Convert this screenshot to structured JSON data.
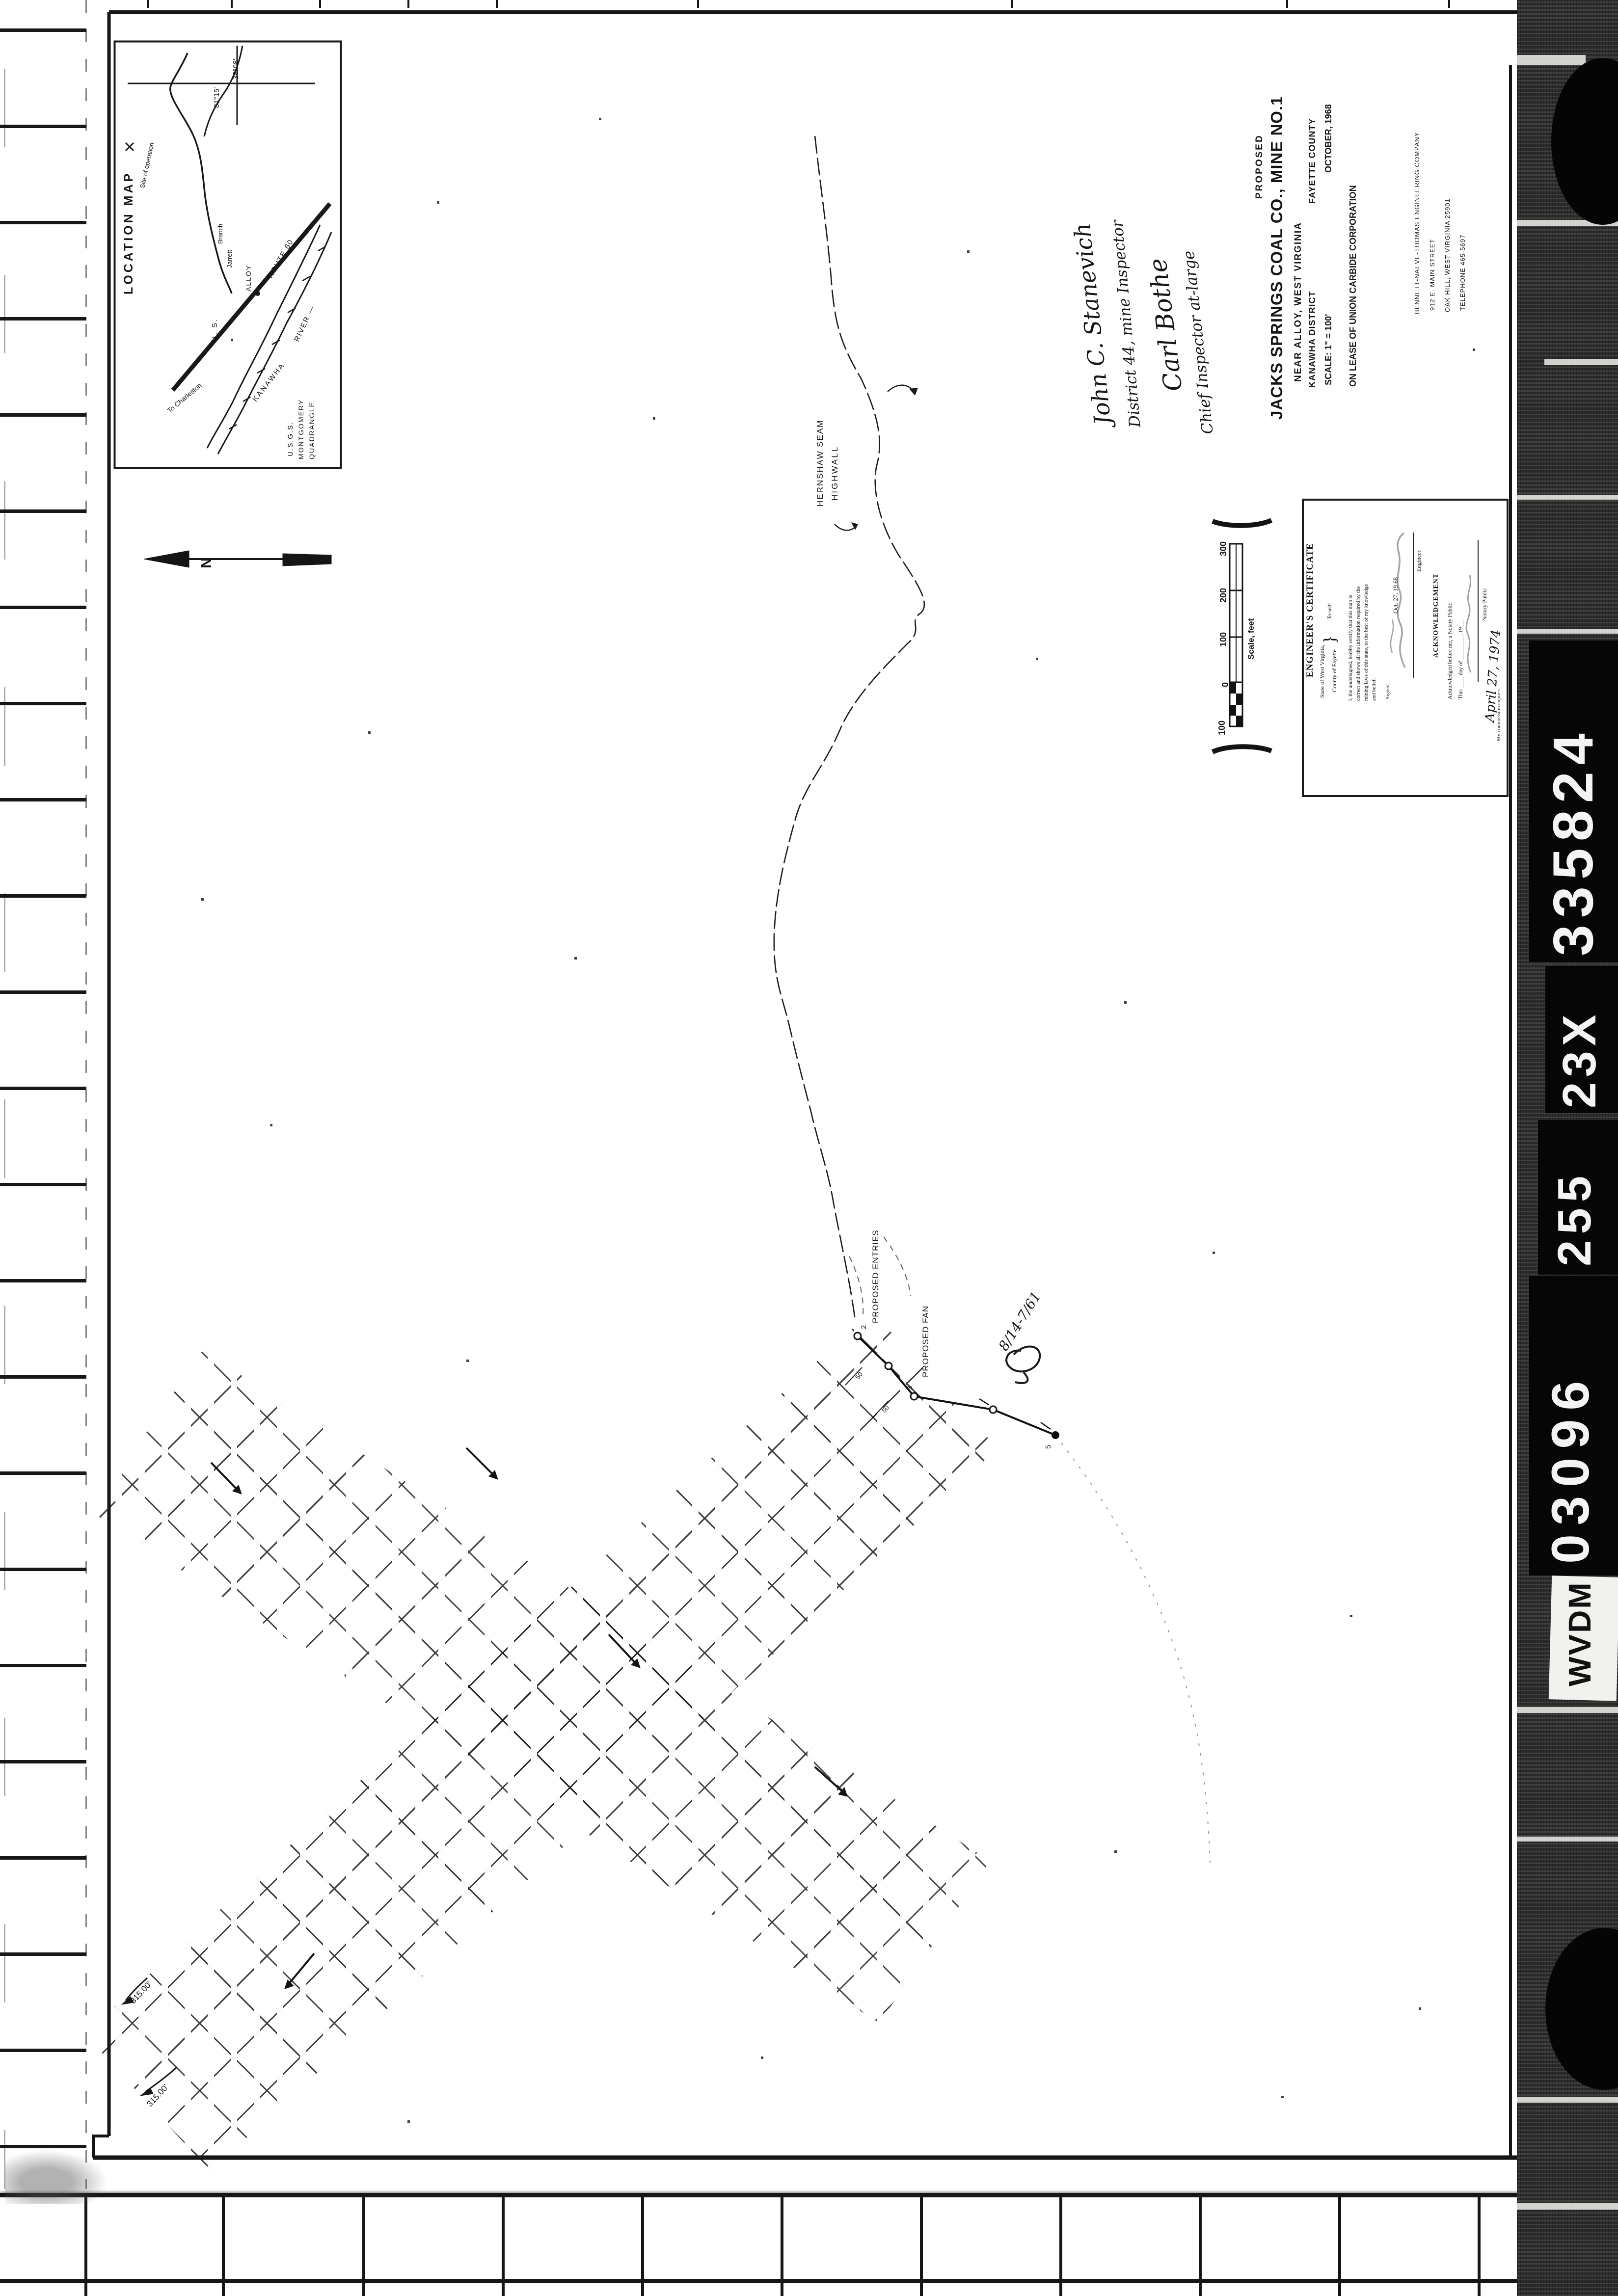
{
  "film": {
    "codes": [
      "335824",
      "23X",
      "255",
      "03096"
    ],
    "reel_label": "WVDM"
  },
  "inset": {
    "title": "LOCATION MAP",
    "lat": "38°08'",
    "lon": "81°15'",
    "site": "Site of operation",
    "branch_1": "Jarrett",
    "branch_2": "Branch",
    "town": "ALLOY",
    "road_us": "U. S.",
    "road_route": "ROUTE 60",
    "to_charleston": "To Charleston",
    "river_1": "KANAWHA",
    "river_2": "RIVER —",
    "quad_1": "U.S.G.S.",
    "quad_2": "MONTGOMERY",
    "quad_3": "QUADRANGLE"
  },
  "compass": {
    "north": "N"
  },
  "title_block": {
    "proposed": "PROPOSED",
    "title": "JACKS SPRINGS COAL CO., MINE NO.1",
    "near": "NEAR  ALLOY, WEST VIRGINIA",
    "district": "KANAWHA DISTRICT",
    "county": "FAYETTE COUNTY",
    "scale": "SCALE: 1\" = 100'",
    "date": "OCTOBER, 1968",
    "lease": "ON  LEASE  OF  UNION  CARBIDE  CORPORATION",
    "firm": "BENNETT-NAEVE-THOMAS  ENGINEERING  COMPANY",
    "firm_addr1": "912  E.  MAIN  STREET",
    "firm_addr2": "OAK  HILL, WEST  VIRGINIA   25901",
    "firm_phone": "TELEPHONE  465-5697"
  },
  "signatures": {
    "sig1": "John C. Stanevich",
    "sig1_title": "District 44, mine Inspector",
    "sig2": "Carl Bothe",
    "sig2_title": "Chief Inspector at-large"
  },
  "certificate": {
    "heading": "ENGINEER'S CERTIFICATE",
    "state": "State of West Virginia,",
    "brace": "}",
    "towit": "To-wit:",
    "county": "County of Fayette",
    "body1": "I, the undersigned, hereby certify that this map is",
    "body2": "correct and shows all the information required by the",
    "body3": "mining laws of this state, to the best of my knowledge",
    "body4": "and belief.",
    "signed": "Signed",
    "date_line": "Oct. 27, 19 68",
    "engineer": "Engineer",
    "ack": "ACKNOWLEDGEMENT",
    "ack1": "Acknowledged before me, a Notary Public",
    "ack2": "This ____ day of ________ , 19 __",
    "notary": "Notary Public",
    "notary_script": "April 27, 1974",
    "commission": "My commission expires"
  },
  "scalebar": {
    "ticks": [
      "300",
      "200",
      "100",
      "0",
      "100"
    ],
    "caption": "Scale, feet"
  },
  "labels": {
    "seam": "HERNSHAW  SEAM",
    "highwall": "HIGHWALL",
    "entries": "PROPOSED  ENTRIES",
    "fan": "PROPOSED  FAN",
    "dim1": "315.00'",
    "dim2": "315.00'",
    "fifty_a": "50",
    "fifty_b": "50",
    "note": "8/14-7/61",
    "st2": "2",
    "st3": "3",
    "st5": "5"
  }
}
